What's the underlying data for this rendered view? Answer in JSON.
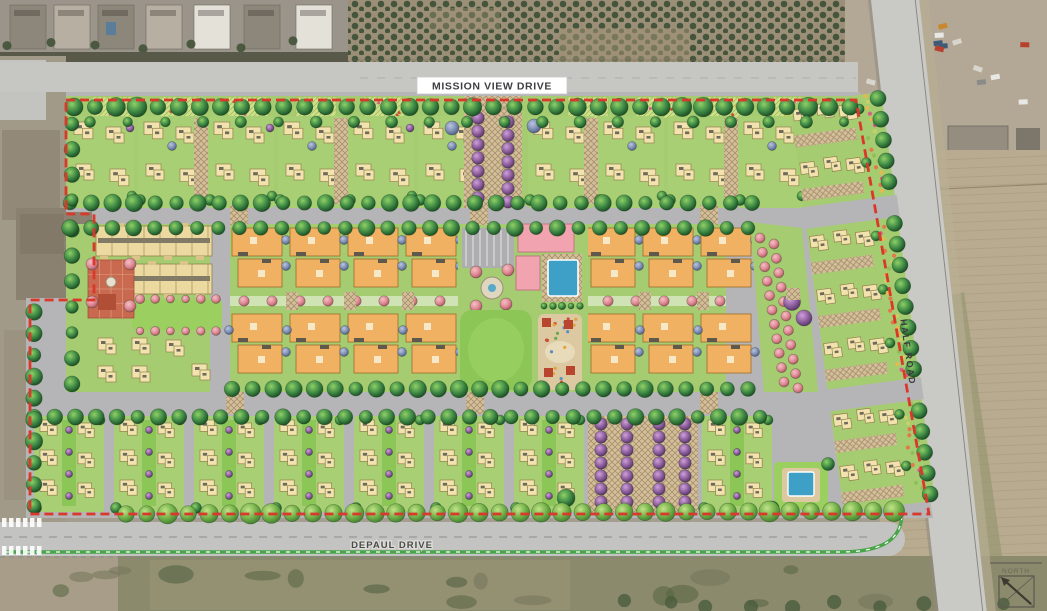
{
  "title": "Residential community master site plan (aerial overlay rendering)",
  "streets": {
    "mission_view": "MISSION VIEW DRIVE",
    "depaul": "DEPAUL DRIVE",
    "half_road": "HALF ROAD"
  },
  "north_arrow_label": "NORTH",
  "colors": {
    "street": "#b5b5b7",
    "road": "#c7c7c3",
    "lawn": "#a6cc72",
    "lawn_bright": "#9bd060",
    "lawn_dark": "#8cc656",
    "house": "#f2e3ae",
    "house_edge": "#93804d",
    "condo": "#f1b163",
    "condo_edge": "#a3742f",
    "townhouse": "#ecd9a0",
    "clubhouse": "#f2a3b0",
    "clubhouse_edge": "#c27683",
    "pool": "#3e9fc7",
    "paver": "#d3c09a",
    "paver_line": "#a88f6d",
    "plaza": "#c96a50",
    "boundary": "#d9382a",
    "tree_dark": "#1e5b33",
    "tree_mid": "#3f8a46",
    "tree_light": "#86c95e",
    "purple_tree": "#8e5f9e",
    "pink_tree": "#e08a96",
    "blue_tree": "#7f8fb5",
    "aerial_dirt": "#a29a88",
    "orchard_soil": "#9c8f78",
    "orchard_tree": "#44553b",
    "field": "#b9ab90",
    "scrub": "#8c8a6d",
    "label_text": "#3f3f43"
  }
}
